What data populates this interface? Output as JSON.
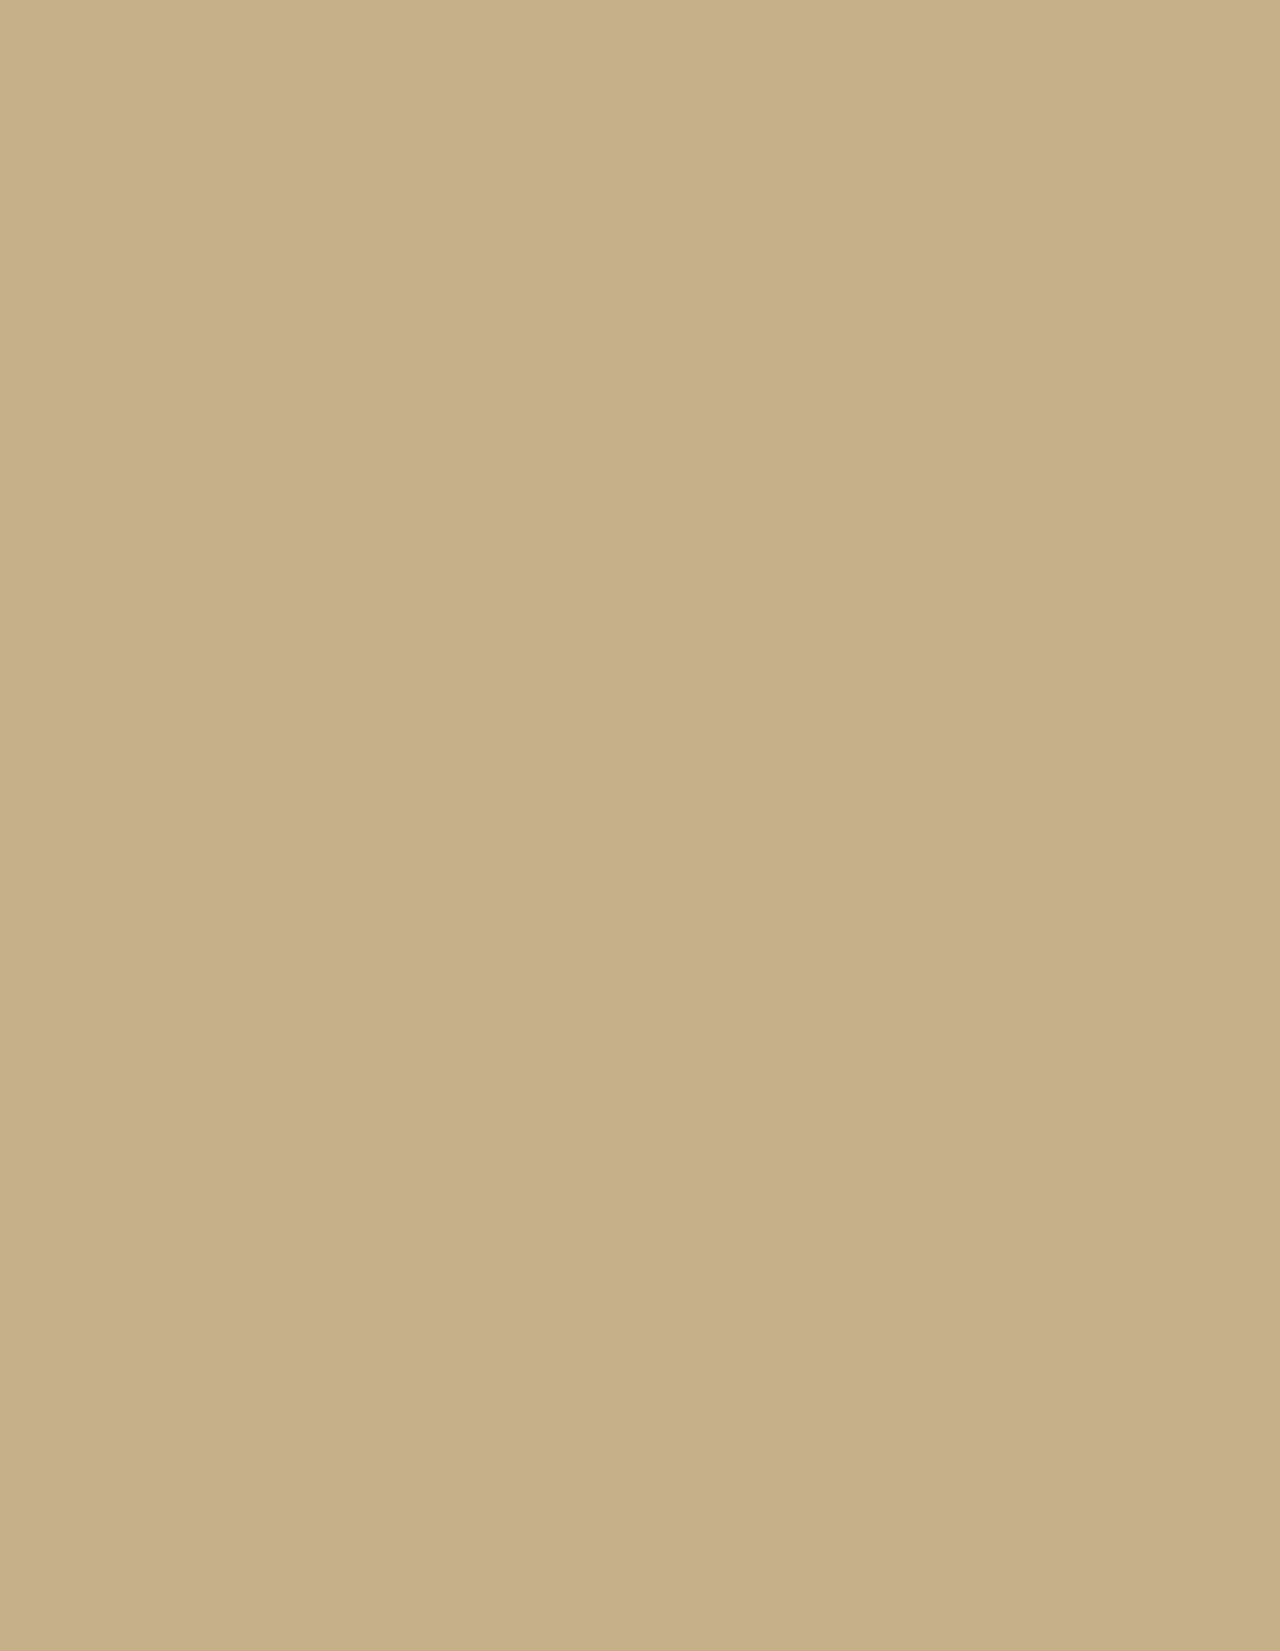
{
  "meta": {
    "width": 1280,
    "height": 1651
  },
  "header": {
    "height": 138,
    "gradient": [
      [
        "0%",
        "rgba(14,11,9,0.96)"
      ],
      [
        "35%",
        "rgba(17,14,11,0.93)"
      ],
      [
        "55%",
        "rgba(40,34,27,0.72)"
      ],
      [
        "72%",
        "rgba(72,61,48,0.35)"
      ],
      [
        "90%",
        "rgba(0,0,0,0)"
      ]
    ]
  },
  "scene": {
    "size": {
      "w": 1280,
      "h": 1651
    },
    "base_color": "#c7b18c",
    "road_color": "#a8a39b",
    "tree_row_color": "#4e5a36",
    "patches": [
      [
        1150,
        300,
        260,
        280,
        "#d7c5a2",
        0.9
      ],
      [
        1200,
        900,
        200,
        400,
        "#d3c09c",
        0.8
      ],
      [
        150,
        1250,
        300,
        300,
        "#a8916f",
        0.55
      ],
      [
        100,
        550,
        180,
        250,
        "#c0ab85",
        0.6
      ],
      [
        600,
        1580,
        500,
        150,
        "#b7a17d",
        0.5
      ],
      [
        480,
        1350,
        260,
        180,
        "#d9c39c",
        0.7
      ],
      [
        250,
        200,
        300,
        120,
        "#c2ad87",
        0.6
      ],
      [
        660,
        580,
        420,
        380,
        "#cdb892",
        0.5
      ],
      [
        60,
        850,
        120,
        300,
        "#cdbb98",
        0.6
      ],
      [
        1220,
        1550,
        150,
        120,
        "#a4906e",
        0.5
      ]
    ],
    "green_field": {
      "x": 186,
      "y": 171,
      "w": 116,
      "h": 73,
      "fill": "#3f4f2c",
      "rot": -2
    },
    "speckles": [
      {
        "seed": 42,
        "count": 650,
        "x": 0,
        "y": 138,
        "w": 1280,
        "h": 1510,
        "color": "#6f5f47",
        "rmin": 0.7,
        "rmax": 2.0,
        "op": 0.4
      },
      {
        "seed": 7,
        "count": 420,
        "x": 0,
        "y": 1040,
        "w": 430,
        "h": 611,
        "color": "#5a4c38",
        "rmin": 1.0,
        "rmax": 2.6,
        "op": 0.5
      },
      {
        "seed": 13,
        "count": 260,
        "x": 1055,
        "y": 140,
        "w": 225,
        "h": 1500,
        "color": "#7a6a50",
        "rmin": 0.8,
        "rmax": 2.2,
        "op": 0.5
      },
      {
        "seed": 99,
        "count": 90,
        "x": 880,
        "y": 0,
        "w": 400,
        "h": 140,
        "color": "#6f5f47",
        "rmin": 0.7,
        "rmax": 1.8,
        "op": 0.4
      }
    ],
    "roads": [
      [
        "M96,263 H1116",
        7
      ],
      [
        "M99,263 V1068 Q99,1112 132,1134 L228,1161",
        7
      ],
      [
        "M1114,263 V980 Q1114,1022 1086,1048 L998,1136 Q976,1158 934,1159 L228,1161",
        7
      ],
      [
        "M228,1161 L557,1513 Q571,1528 593,1529 L731,1530 Q862,1521 1006,1459 Q1112,1412 1280,1427",
        8
      ],
      [
        "M593,1529 Q642,1582 690,1651",
        6
      ],
      [
        "M546,128 V263",
        6
      ],
      [
        "M521,263 V905",
        6
      ],
      [
        "M742,305 V1159",
        6
      ],
      [
        "M938,263 V878",
        6
      ],
      [
        "M423,263 V663",
        5
      ],
      [
        "M870,663 V1159",
        5
      ],
      [
        "M423,305 H1114",
        5
      ],
      [
        "M99,390 H1114",
        6
      ],
      [
        "M223,512 H742",
        5
      ],
      [
        "M223,390 V663",
        5
      ],
      [
        "M99,663 H1114",
        6
      ],
      [
        "M423,880 H1114",
        6
      ],
      [
        "M742,758 H1114",
        5
      ],
      [
        "M521,905 H742",
        5
      ],
      [
        "M660,905 V1159",
        5
      ],
      [
        "M601,1159 V1253",
        5
      ],
      [
        "M601,1253 H746",
        5
      ],
      [
        "M746,1253 V1528",
        5
      ],
      [
        "M657,1292 H746",
        5
      ],
      [
        "M746,1445 H1060",
        5
      ],
      [
        "M1114,263 L1237,127",
        4
      ],
      [
        "M99,263 V196 Q99,162 130,156 L258,148",
        5
      ]
    ],
    "road_ellipses": [
      {
        "cx": 560,
        "cy": 176,
        "rx": 17,
        "ry": 31,
        "w": 5
      },
      {
        "cx": 366,
        "cy": 268,
        "rx": 13,
        "ry": 13,
        "w": 5
      }
    ],
    "parking": {
      "x": 330,
      "y": 145,
      "w": 325,
      "h": 100,
      "fill": "#beb097",
      "stripe_color": "#d9d3c2",
      "stripe_ys": [
        168,
        193,
        218
      ]
    },
    "orchard": {
      "x": 155,
      "y": 690,
      "w": 170,
      "h": 105,
      "op": 0.85
    },
    "tree_rows": [
      [
        509,
        275,
        509,
        903,
        13,
        "10 7"
      ],
      [
        535,
        275,
        535,
        903,
        12,
        "9 8"
      ],
      [
        558,
        362,
        1058,
        362,
        16,
        "14 8"
      ],
      [
        600,
        380,
        1050,
        380,
        10,
        "8 10"
      ],
      [
        230,
        657,
        1058,
        657,
        12,
        "12 9"
      ],
      [
        110,
        430,
        110,
        662,
        10,
        "9 7"
      ],
      [
        340,
        240,
        650,
        240,
        8,
        "6 12"
      ],
      [
        340,
        190,
        650,
        190,
        6,
        "5 14"
      ],
      [
        432,
        878,
        432,
        1012,
        12,
        "12 8"
      ],
      [
        465,
        885,
        465,
        1060,
        10,
        "10 9"
      ],
      [
        255,
        148,
        420,
        144,
        8,
        "8 8"
      ],
      [
        748,
        700,
        748,
        878,
        9,
        "8 9"
      ],
      [
        230,
        517,
        420,
        517,
        8,
        "7 9"
      ],
      [
        872,
        690,
        872,
        860,
        8,
        "7 10"
      ]
    ],
    "tree_patches": [
      [
        640,
        352,
        85,
        48,
        "#49552f",
        0.9
      ],
      [
        950,
        360,
        100,
        40,
        "#4d5833",
        0.85
      ],
      [
        760,
        345,
        60,
        35,
        "#45512d",
        0.85
      ],
      [
        585,
        620,
        60,
        55,
        "#4c5731",
        0.8
      ],
      [
        700,
        600,
        45,
        40,
        "#515c36",
        0.75
      ],
      [
        450,
        950,
        55,
        70,
        "#4a5530",
        0.85
      ],
      [
        520,
        870,
        40,
        25,
        "#4e5933",
        0.8
      ],
      [
        1040,
        700,
        45,
        30,
        "#505b35",
        0.7
      ],
      [
        860,
        430,
        40,
        28,
        "#4b5630",
        0.8
      ],
      [
        800,
        300,
        55,
        22,
        "#4f5a34",
        0.7
      ],
      [
        700,
        225,
        50,
        28,
        "#4c5731",
        0.6
      ],
      [
        850,
        180,
        40,
        20,
        "#55603a",
        0.5
      ],
      [
        190,
        1290,
        170,
        150,
        "#6a6049",
        0.5
      ],
      [
        90,
        1180,
        120,
        90,
        "#71644c",
        0.45
      ],
      [
        300,
        980,
        90,
        60,
        "#8a7a5c",
        0.35
      ],
      [
        60,
        1620,
        140,
        60,
        "#937c5a",
        0.5
      ]
    ],
    "buildings": [
      [
        505,
        243,
        57,
        22,
        "#e3e0d6"
      ],
      [
        448,
        186,
        50,
        40,
        "#ddd9cc"
      ],
      [
        470,
        118,
        26,
        16,
        "#e6e3da"
      ],
      [
        420,
        318,
        98,
        34,
        "#e9e7df"
      ],
      [
        575,
        298,
        85,
        20,
        "#e6e4db"
      ],
      [
        588,
        326,
        55,
        16,
        "#d6d2c6"
      ],
      [
        875,
        295,
        60,
        36,
        "#e9e7e0"
      ],
      [
        1012,
        300,
        40,
        22,
        "#ddd9cd"
      ],
      [
        655,
        298,
        18,
        42,
        "#c9c2b0"
      ],
      [
        700,
        232,
        34,
        20,
        "#d9d5c9"
      ],
      [
        745,
        238,
        26,
        16,
        "#cfcaba"
      ],
      [
        283,
        435,
        62,
        24,
        "#eceae2"
      ],
      [
        293,
        468,
        58,
        24,
        "#e8e6de"
      ],
      [
        297,
        503,
        50,
        24,
        "#e7e5dd"
      ],
      [
        188,
        428,
        28,
        62,
        "#e4e1d7"
      ],
      [
        238,
        430,
        30,
        22,
        "#c4c0b4"
      ],
      [
        196,
        515,
        34,
        24,
        "#dedbd0"
      ],
      [
        368,
        450,
        28,
        80,
        "#e9e7e0"
      ],
      [
        472,
        455,
        58,
        52,
        "#e7e4da"
      ],
      [
        253,
        562,
        112,
        24,
        "#ebe9e1"
      ],
      [
        248,
        622,
        120,
        38,
        "#e9e7df"
      ],
      [
        180,
        588,
        26,
        72,
        "#9e5d45"
      ],
      [
        420,
        560,
        40,
        20,
        "#d9d5c9"
      ],
      [
        492,
        598,
        40,
        26,
        "#e6e3da"
      ],
      [
        518,
        632,
        42,
        28,
        "#c2beb2"
      ],
      [
        572,
        552,
        52,
        26,
        "#e8e6de"
      ],
      [
        575,
        698,
        82,
        58,
        "#b4b0a6"
      ],
      [
        590,
        758,
        50,
        46,
        "#a9a59b"
      ],
      [
        600,
        806,
        46,
        68,
        "#b0aca1"
      ],
      [
        582,
        843,
        58,
        28,
        "#dcd9cf"
      ],
      [
        663,
        693,
        80,
        64,
        "#b9b5aa"
      ],
      [
        678,
        772,
        64,
        26,
        "#c6c2b6"
      ],
      [
        625,
        895,
        62,
        40,
        "#cdbb95"
      ],
      [
        788,
        588,
        110,
        54,
        "#b5b1a6"
      ],
      [
        912,
        552,
        52,
        98,
        "#c0bcb1"
      ],
      [
        768,
        688,
        132,
        70,
        "#b2aea3"
      ],
      [
        912,
        688,
        96,
        68,
        "#bbb7ac"
      ],
      [
        798,
        772,
        120,
        66,
        "#b7b3a8"
      ],
      [
        938,
        788,
        62,
        42,
        "#c3bfb4"
      ],
      [
        855,
        412,
        52,
        62,
        "#e8e6de"
      ],
      [
        952,
        428,
        48,
        36,
        "#e5e2d9"
      ],
      [
        1008,
        452,
        38,
        26,
        "#ddd9cd"
      ],
      [
        1030,
        688,
        36,
        42,
        "#e3e0d6"
      ],
      [
        1040,
        752,
        32,
        22,
        "#d8d4c8"
      ],
      [
        727,
        952,
        44,
        84,
        "#c4b591"
      ],
      [
        727,
        1036,
        44,
        88,
        "#98a3a6"
      ],
      [
        768,
        930,
        60,
        34,
        "#cfc0a0"
      ],
      [
        795,
        980,
        40,
        28,
        "#c9c4b8"
      ],
      [
        852,
        1005,
        40,
        30,
        "#cbc6ba"
      ],
      [
        900,
        1062,
        36,
        26,
        "#d2cec2"
      ],
      [
        985,
        1018,
        34,
        24,
        "#ddd9cd"
      ],
      [
        1022,
        1068,
        46,
        30,
        "#d6d2c6"
      ],
      [
        1088,
        1108,
        40,
        24,
        "#e0ddd2"
      ],
      [
        888,
        872,
        40,
        26,
        "#c9c5b9"
      ],
      [
        962,
        880,
        34,
        22,
        "#d2cec2"
      ],
      [
        1005,
        905,
        60,
        36,
        "#c5c1b5"
      ],
      [
        795,
        905,
        48,
        30,
        "#beb9ad"
      ],
      [
        516,
        1022,
        122,
        52,
        "#c9b58c"
      ],
      [
        558,
        972,
        80,
        46,
        "#d8d1c1"
      ],
      [
        600,
        1094,
        40,
        24,
        "#8fa0ad"
      ],
      [
        428,
        1284,
        52,
        22,
        "#dad6ca",
        3
      ],
      [
        488,
        1288,
        46,
        20,
        "#e2dfd4",
        2
      ],
      [
        436,
        1312,
        40,
        16,
        "#ddd9cc",
        3
      ],
      [
        496,
        1278,
        34,
        20,
        "#d8d4c8"
      ],
      [
        628,
        1324,
        36,
        30,
        "#b3ab9a"
      ],
      [
        652,
        1458,
        94,
        44,
        "#d8d5c9"
      ],
      [
        620,
        1478,
        48,
        18,
        "#e6e3d9"
      ],
      [
        676,
        1496,
        28,
        16,
        "#ddd9cd"
      ],
      [
        874,
        1252,
        56,
        34,
        "#e3e0d6"
      ],
      [
        968,
        1318,
        44,
        26,
        "#cdbc9a"
      ],
      [
        1014,
        1356,
        132,
        44,
        "#c9c5b9"
      ],
      [
        866,
        1392,
        50,
        28,
        "#e0ddd2"
      ],
      [
        730,
        1452,
        26,
        18,
        "#d5d1c5"
      ],
      [
        30,
        545,
        34,
        22,
        "#e6e3d9"
      ],
      [
        20,
        430,
        40,
        26,
        "#d9d5c9"
      ],
      [
        135,
        415,
        44,
        28,
        "#cfcaba"
      ],
      [
        60,
        638,
        30,
        20,
        "#ddd9cd"
      ],
      [
        8,
        378,
        30,
        20,
        "#d2cec2"
      ]
    ],
    "tanks": [
      [
        405,
        797,
        22
      ],
      [
        455,
        766,
        19
      ],
      [
        516,
        801,
        19
      ],
      [
        508,
        890,
        13
      ]
    ],
    "tank_fill": "#cbb88f",
    "tank_stroke": "#94835f",
    "dome": {
      "cx": 610,
      "cy": 1044,
      "r": 26,
      "stroke": "#8f8d86"
    },
    "reactor_stripes": {
      "x1": 524,
      "x2": 630,
      "step": 17,
      "y1": 1030,
      "y2": 1068,
      "color": "#a8936b"
    },
    "construction": {
      "inner_fill": "#d8c29b",
      "berm": {
        "points": "352,1272 392,1264 576,1460 546,1480",
        "fill": "#c8b28a",
        "op": 0.7
      },
      "haul_road": {
        "x1": 372,
        "y1": 1282,
        "x2": 560,
        "y2": 1478,
        "w": 10,
        "color": "#b5b0a6",
        "op": 0.8
      },
      "pad": {
        "x": 445,
        "y": 1286,
        "w": 190,
        "h": 130,
        "fill": "#b3aea2",
        "op": 0.85
      },
      "pit_frame": {
        "x": 524,
        "y": 1296,
        "w": 92,
        "h": 122,
        "fill": "#57452e"
      },
      "pit": {
        "x": 536,
        "y": 1316,
        "w": 70,
        "h": 98,
        "fill": "#221a10"
      },
      "pit_core": {
        "x": 548,
        "y": 1330,
        "w": 46,
        "h": 72,
        "fill": "#140f08"
      },
      "ribs": {
        "x1": 540,
        "x2": 602,
        "y_start": 1328,
        "y_end": 1404,
        "step": 10,
        "color": "#6a5638",
        "w": 2.5
      },
      "cranes": [
        {
          "x1": 612,
          "y1": 1282,
          "x2": 678,
          "y2": 1332,
          "w": 3,
          "color": "#8d877a"
        },
        {
          "x1": 640,
          "y1": 1352,
          "x2": 700,
          "y2": 1390,
          "w": 2,
          "color": "#8d877a"
        }
      ],
      "red_marks": [
        [
          500,
          1296,
          9,
          5
        ],
        [
          560,
          1210,
          7,
          5
        ],
        [
          522,
          1370,
          8,
          4
        ]
      ],
      "red_color": "#b5402e"
    },
    "pond": {
      "d": "M1280,1425 L1252,1470 Q1241,1490 1248,1512 L1262,1560 Q1255,1610 1280,1630 Z",
      "fill": "#16120c",
      "stroke": "#8d887f",
      "sw": 4
    },
    "power_lines": [
      {
        "x1": 0,
        "y1": 1243,
        "x2": 205,
        "y2": 1432
      },
      {
        "x1": 38,
        "y1": 1236,
        "x2": 235,
        "y2": 1424
      }
    ],
    "power_line_color": "#554836"
  },
  "annotations": {
    "color": "#ffdf00",
    "reactor_outline": {
      "d": "M561,970 L667,970 L667,1024 L652,1024 L652,1080 L513,1080 L513,1018 L561,1018 Z",
      "w": 4.5
    },
    "site_outline": {
      "d": "M346,1261 L649,1258 Q657,1259 657,1267 L657,1292 L705,1295 L706,1328 L679,1331 L679,1411 Q680,1424 695,1427 L727,1428 Q740,1429 740,1443 L740,1515 Q740,1530 725,1530 L564,1530 Q551,1530 542,1519 L344,1289 Q334,1272 346,1261 Z",
      "w": 5
    },
    "arrow": {
      "color": "#ffffff",
      "tail": "M792,1288 Q775,1347 710,1367",
      "w": 4,
      "head": "687,1376 705,1355 714,1380"
    }
  },
  "inset_map": {
    "israel": {
      "d": "M177,1207 L170,1213 L152,1220 L131,1228 L123,1258 L118,1282 L109,1315 L100,1352 L93,1381 L86,1398 L77,1407 L52,1427 L57,1434 L67,1441 L78,1475 L112,1616 L120,1597 L127,1573 L142,1527 L152,1493 L157,1475 L162,1452 L160,1440 L153,1420 L155,1408 L153,1400 L163,1397 L167,1377 L165,1357 L167,1330 L170,1293 L170,1273 L172,1257 L173,1230 L175,1213 Z",
      "fill": "#ffffff",
      "stroke": "#2b2b2b",
      "sw": 1.4
    },
    "west_bank": {
      "d": "M140,1296 L156,1300 L162,1310 L163,1330 L161,1352 L157,1372 L158,1390 L152,1404 L145,1415 L128,1417 L112,1408 L118,1395 L124,1390 L118,1380 L124,1372 L117,1363 L122,1355 L118,1342 L124,1330 L119,1318 L127,1306 Z",
      "fill": "#d4d4d4",
      "stroke": "#555555",
      "sw": 0.8
    },
    "gaza": {
      "d": "M83,1396 L91,1403 L63,1441 L54,1433 Z",
      "fill": "#d4d4d4",
      "stroke": "#555555",
      "sw": 0.8
    },
    "golan": {
      "d": "M181,1211 L192,1206 L200,1225 L198,1247 L194,1261 L186,1273 L180,1269 Z",
      "stroke": "#333333",
      "sw": 1
    },
    "border_line": {
      "x1": 179.5,
      "y1": 1209,
      "x2": 179.5,
      "y2": 1271,
      "w": 3.5,
      "color": "#0d0d0d"
    },
    "marker_dot": {
      "cx": 116,
      "cy": 1447,
      "r": 9,
      "color": "#0a0a0a"
    },
    "marker_square": {
      "x": 123,
      "y": 1444,
      "size": 19,
      "color": "#ec1313"
    }
  }
}
